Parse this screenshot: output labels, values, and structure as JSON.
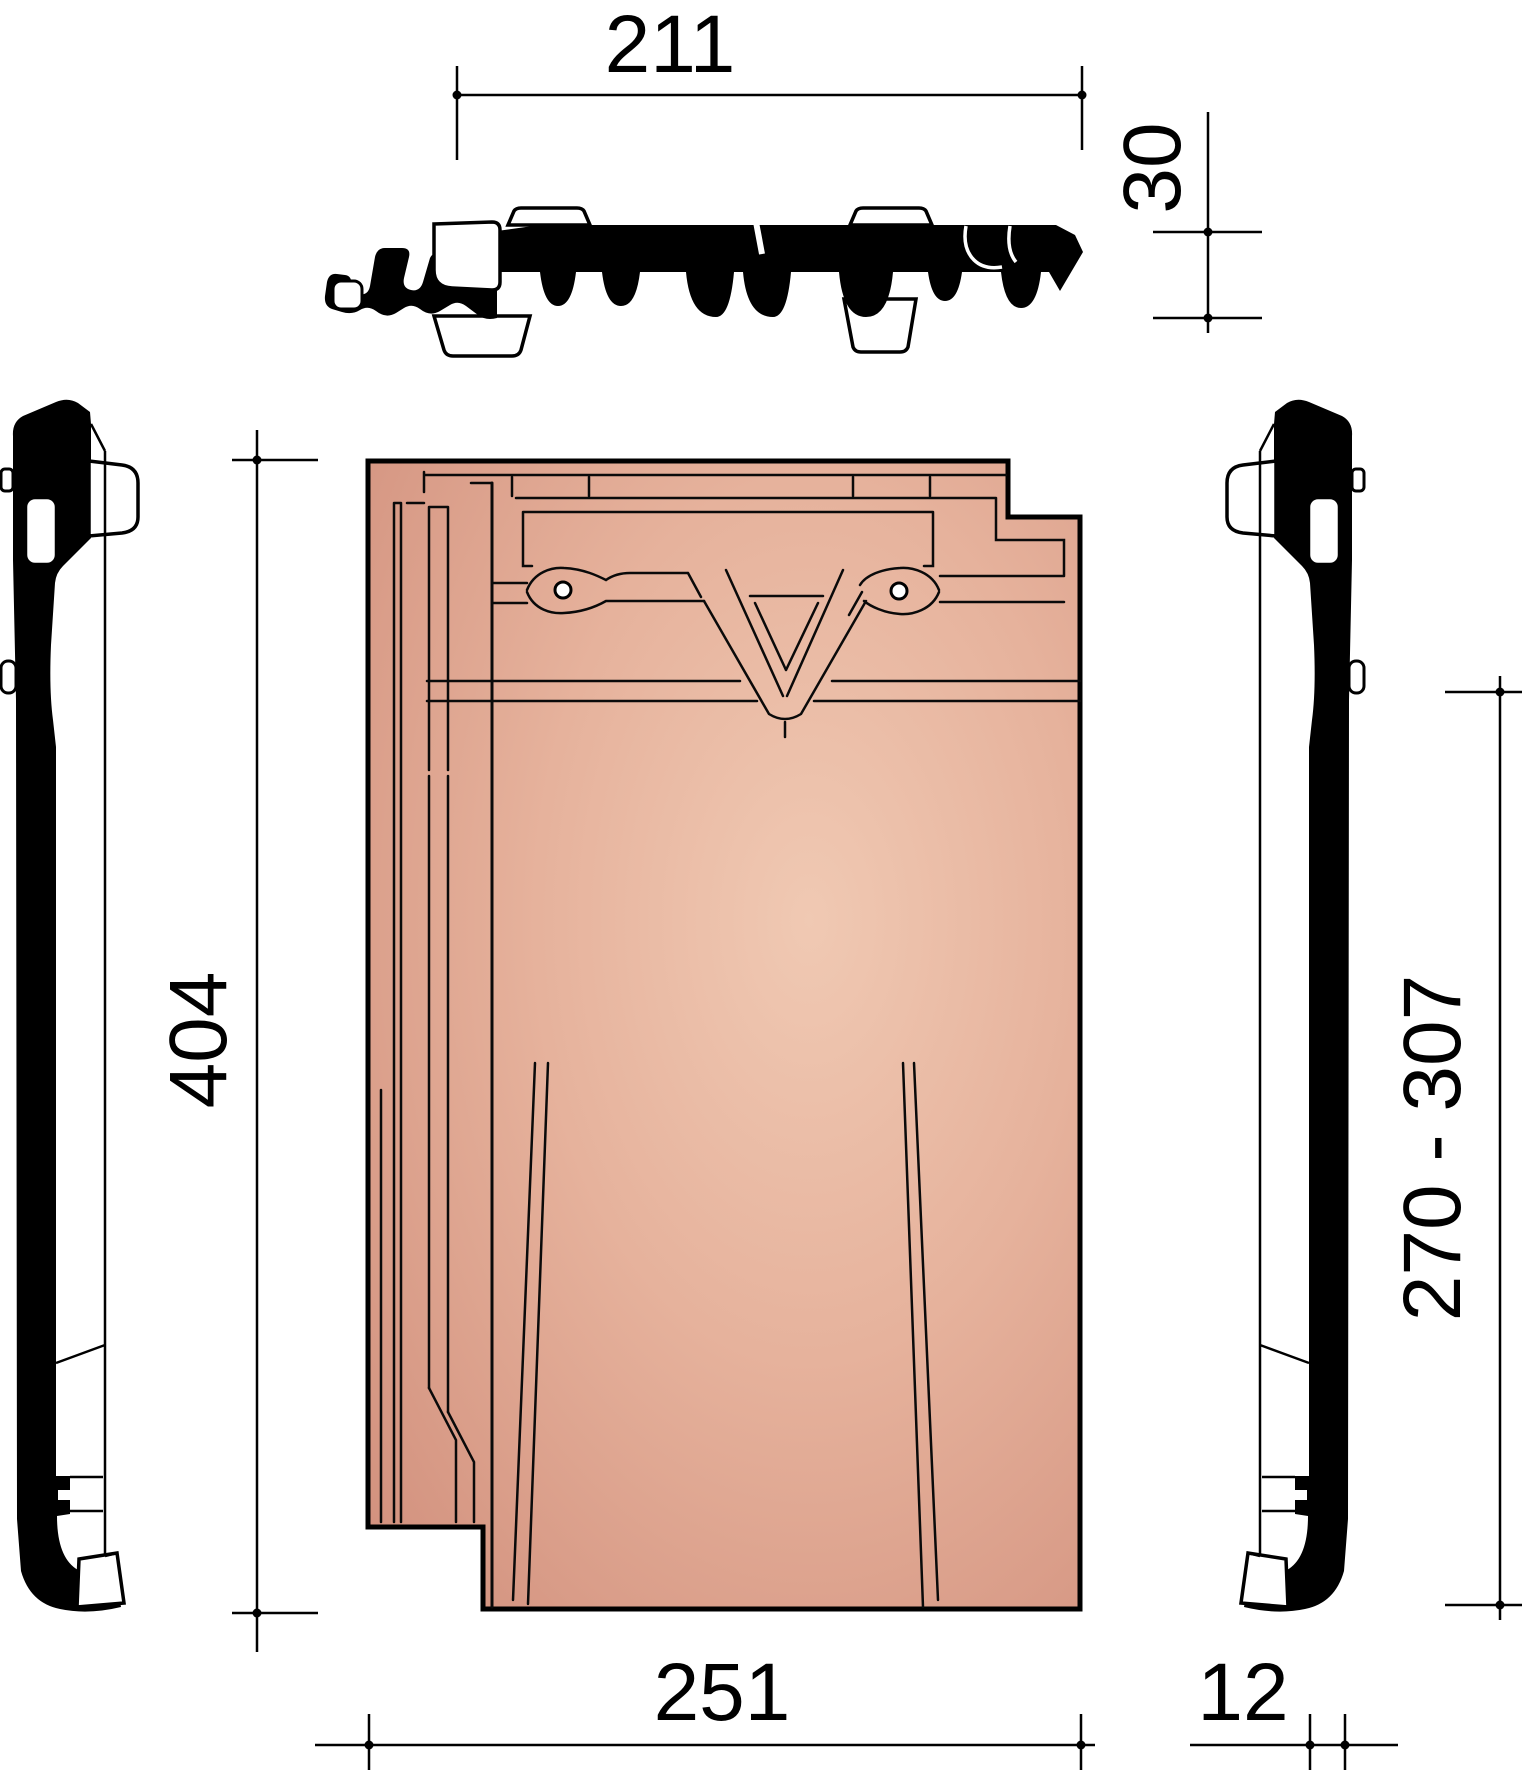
{
  "drawing": {
    "type": "roof-tile-technical-drawing",
    "dimensions": {
      "covering_width": "211",
      "profile_height": "30",
      "tile_length": "404",
      "batten_distance": "270 - 307",
      "tile_width": "251",
      "side_thickness": "12"
    },
    "colors": {
      "tile_face_light": "#eec5af",
      "tile_face_mid": "#e2ab95",
      "tile_face_dark": "#d18f7c",
      "line": "#000000",
      "background": "#ffffff"
    }
  }
}
